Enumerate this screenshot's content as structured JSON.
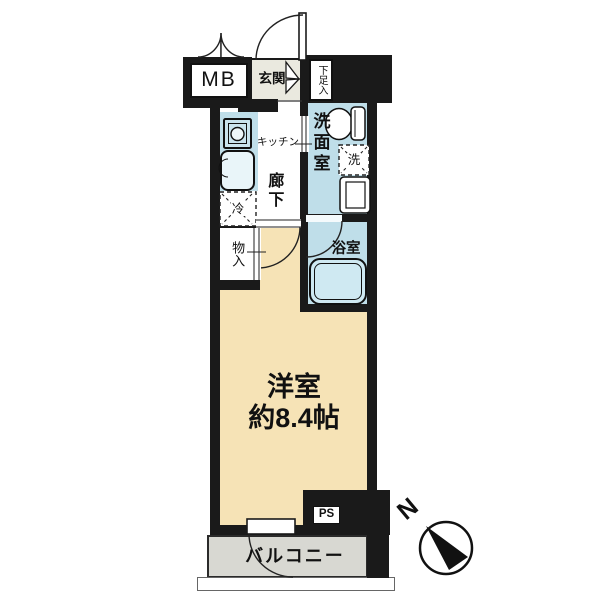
{
  "plan": {
    "rooms": {
      "entrance": {
        "label": "玄関"
      },
      "meter_box": {
        "label": "MB"
      },
      "shoe_cabinet": {
        "label": "下足入"
      },
      "kitchen": {
        "label": "キッチン"
      },
      "hallway": {
        "label": "廊下"
      },
      "washroom": {
        "label": "洗面室"
      },
      "washer": {
        "label": "洗"
      },
      "refrigerator": {
        "label": "冷"
      },
      "bathroom": {
        "label": "浴室"
      },
      "closet": {
        "label": "物入"
      },
      "western_room": {
        "label": "洋室",
        "size": "約8.4帖"
      },
      "pipe_space": {
        "label": "PS"
      },
      "balcony": {
        "label": "バルコニー"
      }
    },
    "compass": {
      "north_label": "N"
    },
    "colors": {
      "wall": "#1a1a1a",
      "wet_area": "#bfdee9",
      "western_room_floor": "#f6e3b6",
      "entrance_floor": "#eae9df",
      "balcony_floor": "#d8d8d2"
    }
  }
}
